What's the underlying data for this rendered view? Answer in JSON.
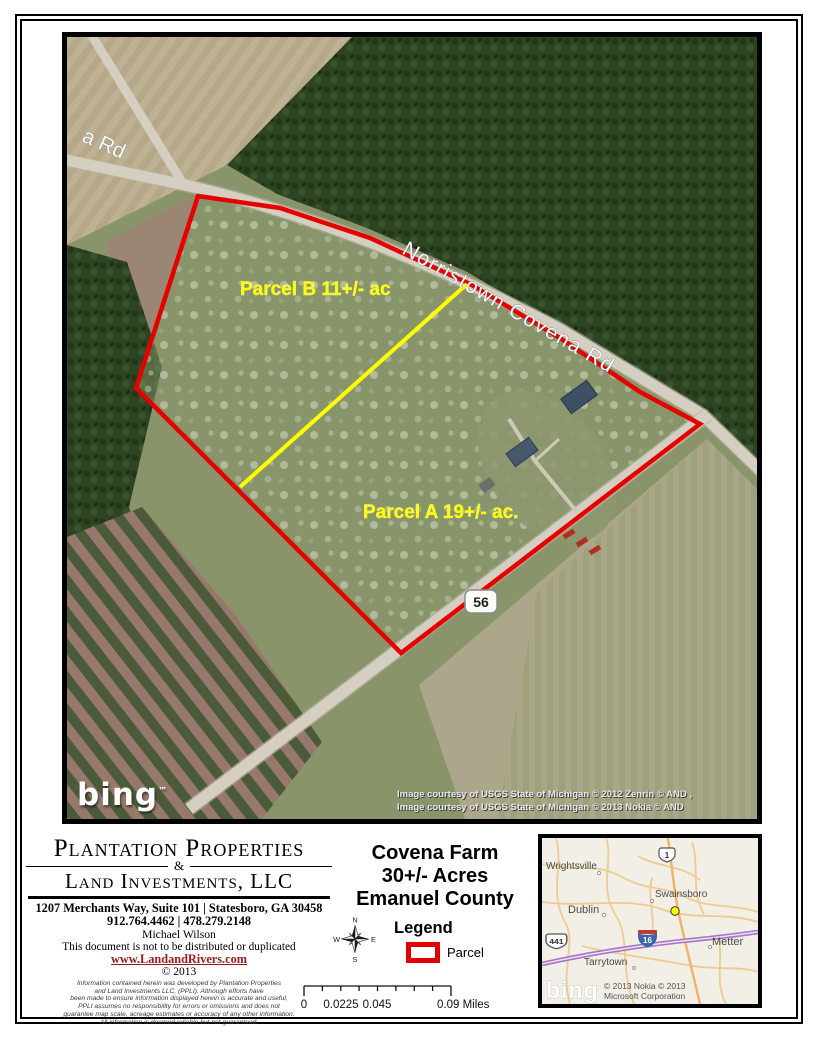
{
  "aerial": {
    "labels": {
      "road_partial": "a Rd",
      "road_main": "Norristown Covena Rd",
      "parcel_b": "Parcel B 11+/- ac",
      "parcel_a": "Parcel A 19+/- ac.",
      "route_shield": "56"
    },
    "bing_logo": "bing",
    "bing_tm": "™",
    "courtesy_line1": "Image courtesy of USGS State of Michigan © 2012 Zenrin © AND ,",
    "courtesy_line2": "Image courtesy of USGS State of Michigan © 2013 Nokia © AND",
    "colors": {
      "parcel_boundary": "#e60000",
      "parcel_divider": "#ffff00",
      "parcel_label_text": "#ffff00"
    }
  },
  "company": {
    "name_line1": "Plantation Properties",
    "ampersand": "&",
    "name_line2": "Land Investments, LLC",
    "address": "1207 Merchants Way, Suite 101 | Statesboro, GA 30458",
    "phones": "912.764.4462 | 478.279.2148",
    "agent": "Michael Wilson",
    "notice": "This document is not to be distributed or duplicated",
    "website": "www.LandandRivers.com",
    "copyright": "© 2013",
    "disclaimer_lines": [
      "Information contained herein was developed by Plantation Properties",
      "and Land Investments LLC, (PPLI).  Although efforts have",
      "been made to ensure information displayed herein is accurate and useful,",
      "PPLI assumes no responsibility for errors or omissions and does not",
      "guarantee map scale, acreage estimates or accuracy of any other information.",
      "All information is deemed reliable but not guaranteed."
    ]
  },
  "title_block": {
    "line1": "Covena Farm",
    "line2": "30+/-  Acres",
    "line3": "Emanuel County",
    "legend_title": "Legend",
    "legend_item": "Parcel"
  },
  "compass": {
    "n": "N",
    "e": "E",
    "s": "S",
    "w": "W"
  },
  "scale_bar": {
    "labels": [
      "0",
      "0.0225",
      "0.045",
      "0.09 Miles"
    ]
  },
  "inset_map": {
    "towns": {
      "wrightsville": "Wrightsville",
      "swainsboro": "Swainsboro",
      "dublin": "Dublin",
      "tarrytown": "Tarrytown",
      "metter": "Metter"
    },
    "shields": {
      "us1": "1",
      "us441": "441",
      "i16": "16"
    },
    "bing_logo": "bing",
    "copyright_line1": "© 2013 Nokia © 2013",
    "copyright_line2": "Microsoft Corporation",
    "marker_color": "#ffff00"
  }
}
